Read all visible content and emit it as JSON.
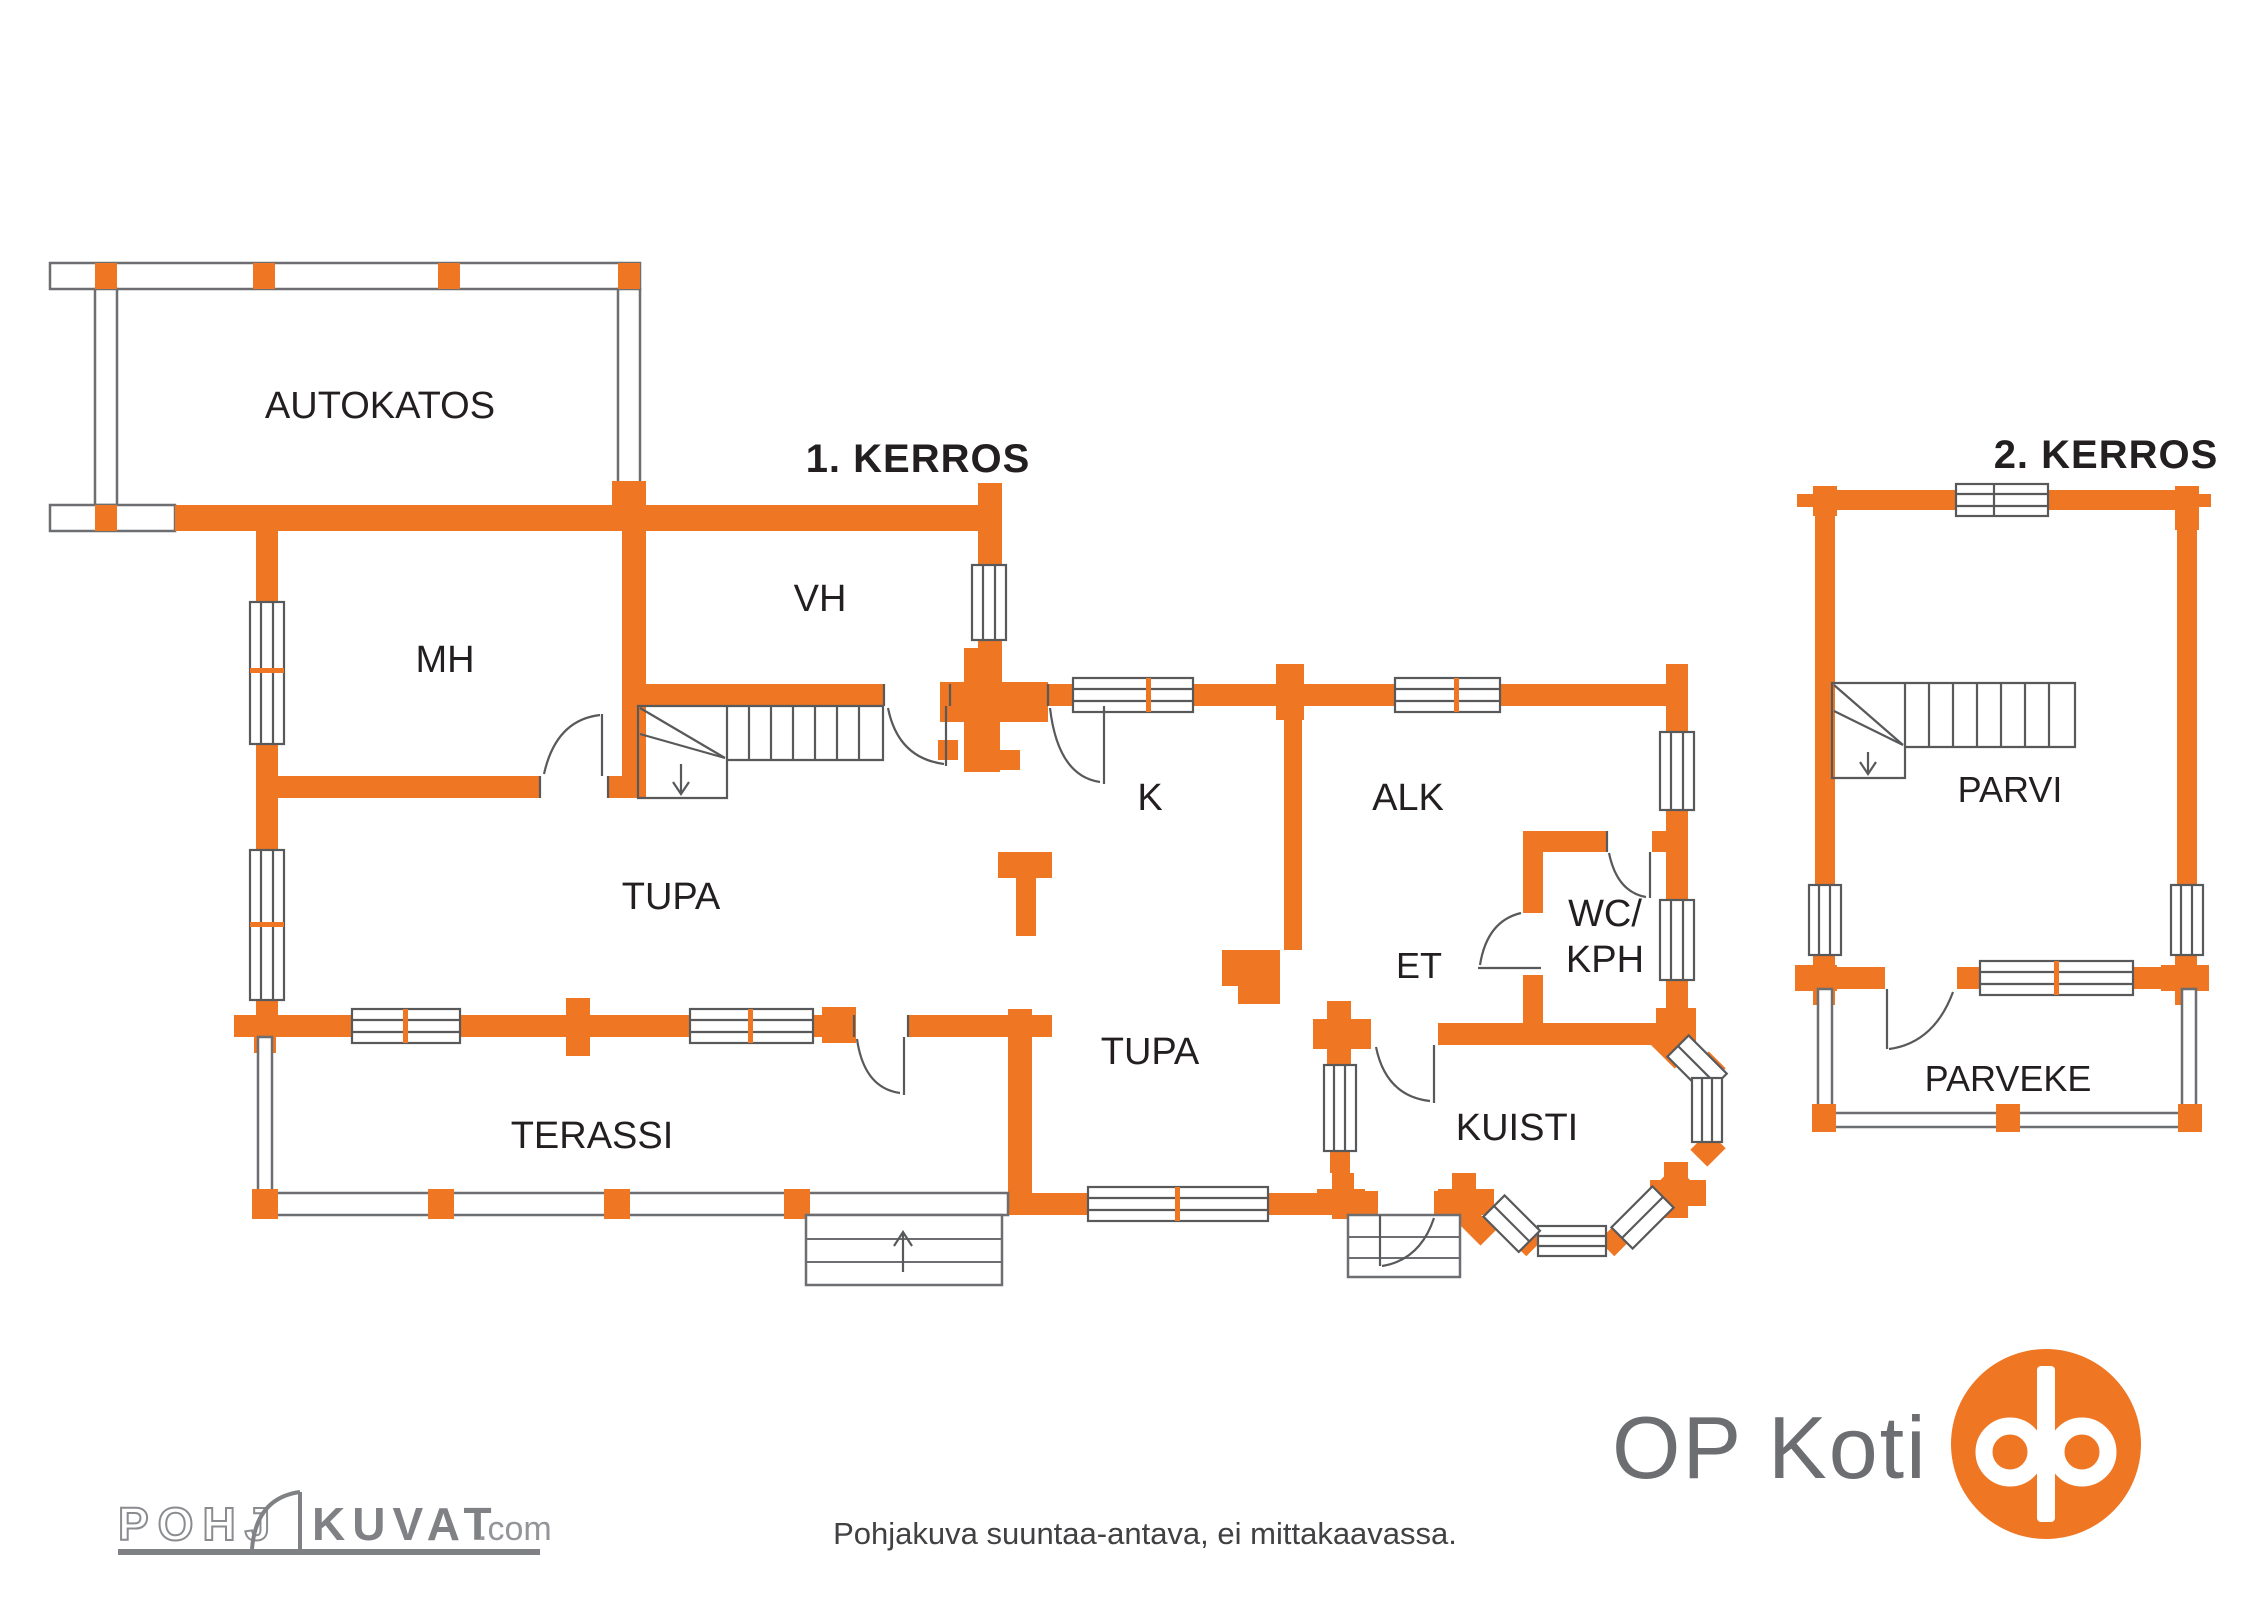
{
  "document": {
    "type": "floor-plan",
    "footer_disclaimer": "Pohjakuva suuntaa-antava, ei mittakaavassa.",
    "colors": {
      "wall_orange": "#EF7623",
      "line_gray": "#58595B",
      "thin_wall_gray": "#6D6E71",
      "label_black": "#231F20",
      "logo_gray": "#808184",
      "op_text_gray": "#6D6E71"
    }
  },
  "floor1": {
    "title": "1. KERROS",
    "rooms": {
      "autokatos": "AUTOKATOS",
      "mh": "MH",
      "vh": "VH",
      "k": "K",
      "alk": "ALK",
      "wc_line1": "WC/",
      "wc_line2": "KPH",
      "et": "ET",
      "tupa_main": "TUPA",
      "tupa_small": "TUPA",
      "terassi": "TERASSI",
      "kuisti": "KUISTI"
    }
  },
  "floor2": {
    "title": "2. KERROS",
    "rooms": {
      "parvi": "PARVI",
      "parveke": "PARVEKE"
    }
  },
  "branding": {
    "watermark_part1": "POHJ",
    "watermark_part2": "KUVAT",
    "watermark_suffix": ".com",
    "op_koti": "OP Koti"
  }
}
